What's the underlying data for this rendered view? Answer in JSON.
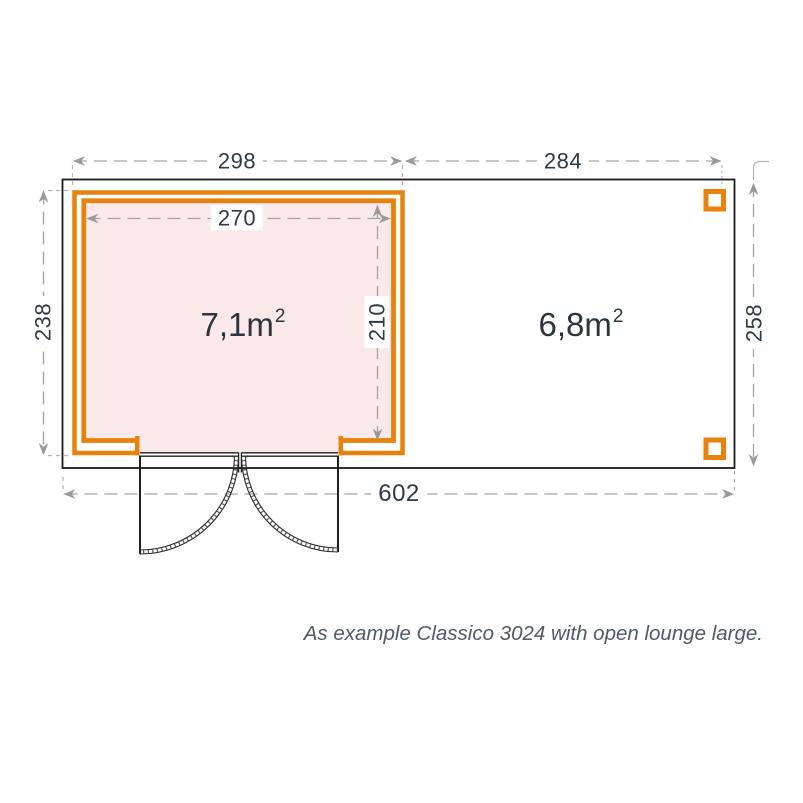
{
  "plan": {
    "name": "garden-house-floor-plan",
    "dimensions": {
      "room_outer_width": "298",
      "lounge_width": "284",
      "room_inner_width": "270",
      "room_outer_height": "238",
      "room_inner_height": "210",
      "total_height": "258",
      "total_width": "602"
    },
    "areas": {
      "room": {
        "value": "7,1m",
        "sup": "2"
      },
      "lounge": {
        "value": "6,8m",
        "sup": "2"
      }
    },
    "caption": "As example Classico 3024 with open lounge large."
  },
  "colors": {
    "wall_orange": "#E8820E",
    "room_fill_pink": "#FBE9E9",
    "outline_black": "#1A1A1A",
    "dimension_gray": "#A3A3A3",
    "extension_gray": "#B3B3B3",
    "dim_text": "#2D3A47",
    "area_text": "#2A3540",
    "caption_text": "#4D5B66"
  }
}
